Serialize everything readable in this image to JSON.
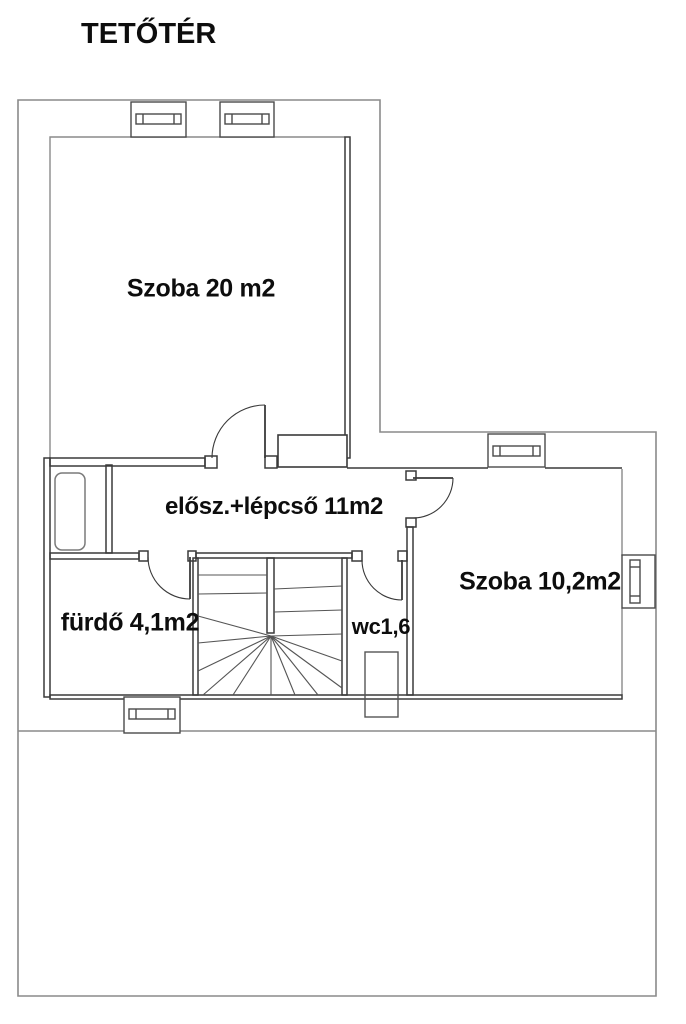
{
  "plan": {
    "title": "TETŐTÉR",
    "rooms": [
      {
        "id": "szoba20",
        "label": "Szoba 20 m2"
      },
      {
        "id": "eloszoba",
        "label": "elősz.+lépcső 11m2"
      },
      {
        "id": "szoba102",
        "label": "Szoba 10,2m2"
      },
      {
        "id": "furdo",
        "label": "fürdő 4,1m2"
      },
      {
        "id": "wc",
        "label": "wc1,6"
      }
    ],
    "colors": {
      "background": "#ffffff",
      "outer_outline": "#8a8a8a",
      "interior_wall": "#3a3a3a",
      "detail_line": "#555555",
      "text": "#0d0d0d"
    }
  }
}
